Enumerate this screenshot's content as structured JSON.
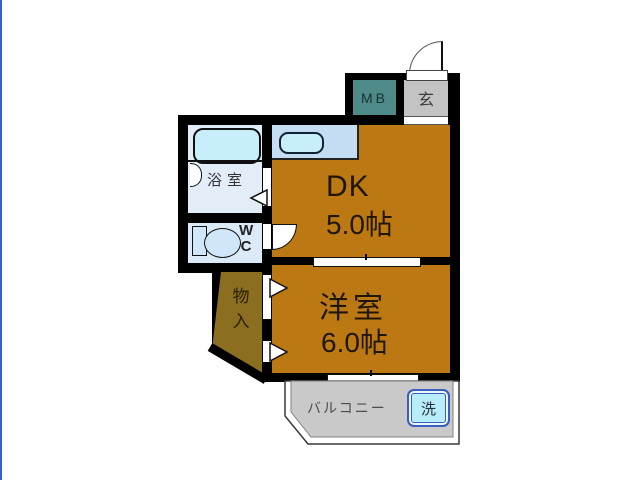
{
  "plan": {
    "title": "apartment-floorplan",
    "colors": {
      "room_orange": "#bc7913",
      "storage_olive": "#8b6e1f",
      "meter_box_teal": "#4e8a88",
      "entrance_gray": "#c3c3c3",
      "balcony_gray": "#c9c9c9",
      "bathroom_bg": "#e3edf8",
      "wc_bg": "#dceaf8",
      "counter_bg": "#c5ddf2",
      "fixture_blue": "#c8eefa",
      "washer_blue": "#b9edf9",
      "washer_border": "#3a5dc0",
      "wall": "#000000",
      "left_edge_line": "#2e64cf"
    },
    "rooms": {
      "dk": {
        "label": "DK",
        "size": "5.0帖"
      },
      "western": {
        "label": "洋室",
        "size": "6.0帖"
      },
      "bathroom": {
        "label": "浴室"
      },
      "wc": {
        "label_w": "W",
        "label_c": "C"
      },
      "storage": {
        "char1": "物",
        "char2": "入"
      },
      "meter_box": {
        "label": "MB"
      },
      "entrance": {
        "label": "玄"
      },
      "balcony": {
        "label": "バルコニー"
      },
      "washer": {
        "label": "洗"
      }
    }
  }
}
